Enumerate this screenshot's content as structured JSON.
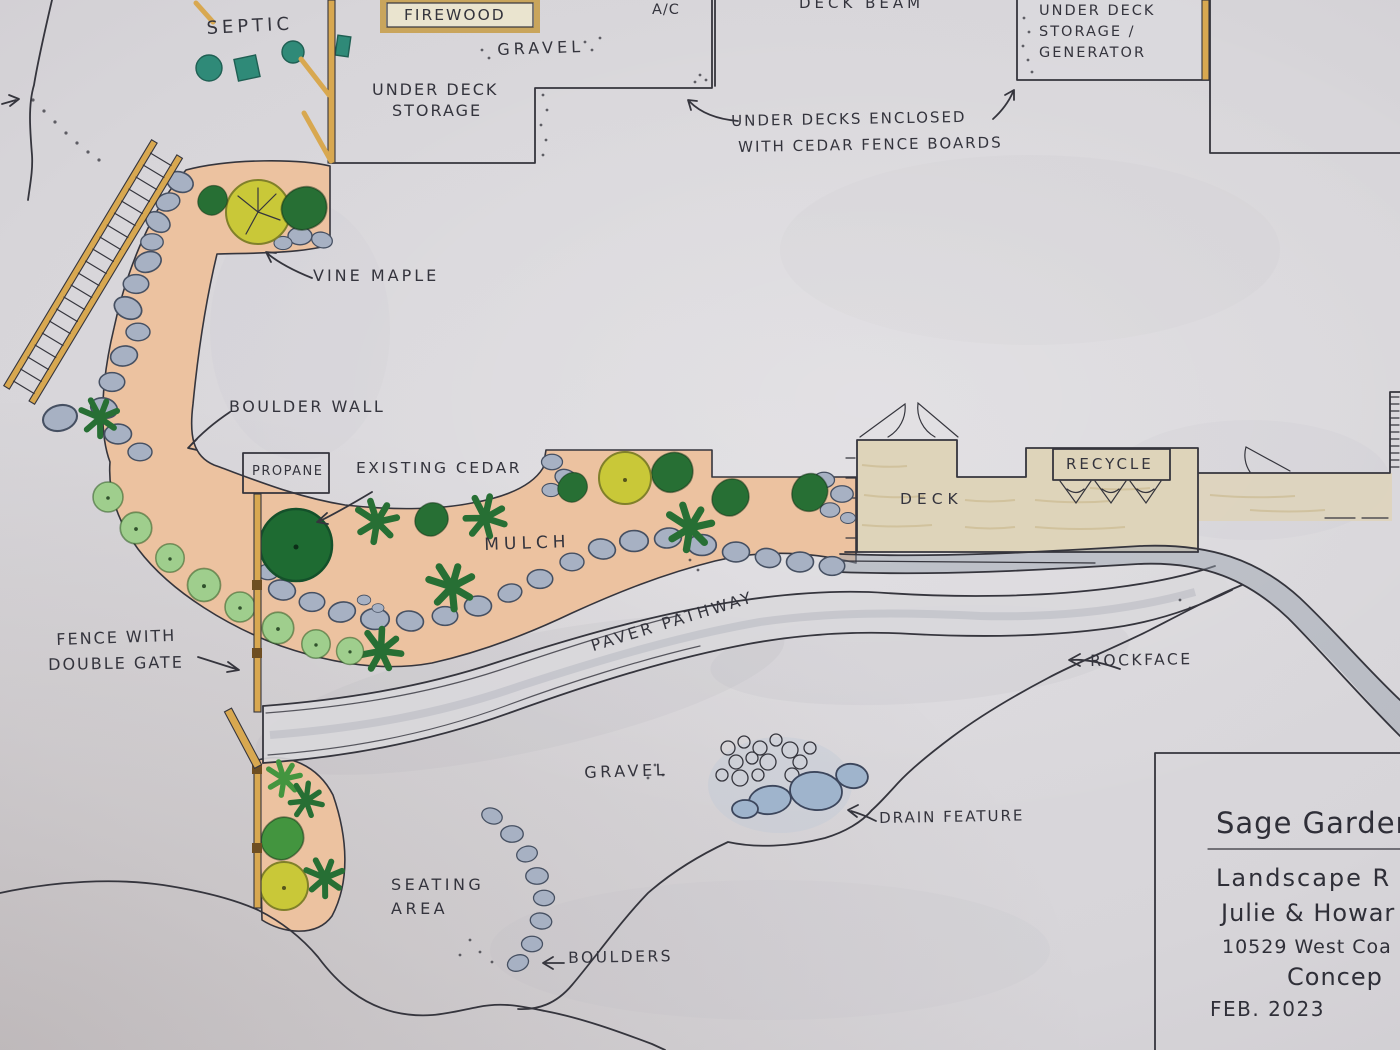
{
  "plan": {
    "labels": {
      "septic": "SEPTIC",
      "firewood": "FIREWOOD",
      "gravel_top": "GRAVEL",
      "under_deck_storage_line1": "UNDER DECK",
      "under_deck_storage_line2": "STORAGE",
      "ac": "A/C",
      "deck_beam": "DECK BEAM",
      "generator_line1": "UNDER DECK",
      "generator_line2": "STORAGE /",
      "generator_line3": "GENERATOR",
      "under_decks_note_line1": "UNDER DECKS ENCLOSED",
      "under_decks_note_line2": "WITH CEDAR FENCE BOARDS",
      "vine_maple": "VINE MAPLE",
      "boulder_wall": "BOULDER WALL",
      "propane": "PROPANE",
      "existing_cedar": "EXISTING CEDAR",
      "mulch": "MULCH",
      "deck": "DECK",
      "recycle": "RECYCLE",
      "fence_note_line1": "FENCE WITH",
      "fence_note_line2": "DOUBLE GATE",
      "paver_pathway": "PAVER PATHWAY",
      "rockface": "ROCKFACE",
      "gravel_south": "GRAVEL",
      "drain_feature": "DRAIN FEATURE",
      "seating_area_line1": "SEATING",
      "seating_area_line2": "AREA",
      "boulders": "BOULDERS"
    },
    "title_block": {
      "project": "Sage Garden",
      "line1": "Landscape R",
      "line2": "Julie & Howar",
      "line3": "10529 West Coa",
      "line4": "Concep",
      "date": "FEB. 2023"
    },
    "colors": {
      "ink": "#35353d",
      "mulch": "#ecc2a0",
      "wood": "#d8a850",
      "wood_dark": "#6e4e22",
      "deck": "#ded4ba",
      "deck_grain": "#c9b98e",
      "boulder": "#a7b1c3",
      "boulder_edge": "#465062",
      "shrub_dark": "#276f34",
      "shrub_mid": "#43953f",
      "shrub_light": "#9fce8d",
      "canopy_yellow": "#c9c838",
      "septic": "#2f8a78",
      "drain_stone": "#9fb4cc",
      "rockband": "#98a1ae",
      "cream": "#eae4cf",
      "tan_border": "#c9a55c"
    }
  }
}
